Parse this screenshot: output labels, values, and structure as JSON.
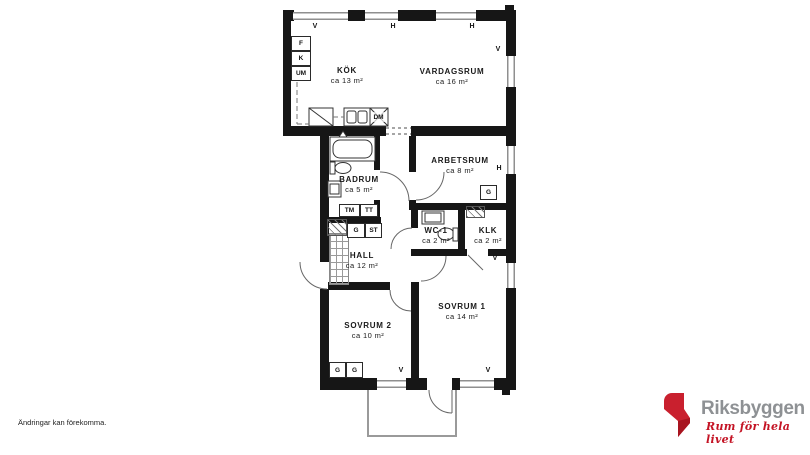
{
  "page": {
    "disclaimer": "Ändringar kan förekomma."
  },
  "brand": {
    "name": "Riksbyggen",
    "tagline": "Rum för hela livet",
    "red": "#c41425",
    "gray": "#8e9194"
  },
  "floorplan": {
    "rooms": [
      {
        "id": "kok",
        "name": "KÖK",
        "area": "ca 13 m²"
      },
      {
        "id": "vardagsrum",
        "name": "VARDAGSRUM",
        "area": "ca 16 m²"
      },
      {
        "id": "arbetsrum",
        "name": "ARBETSRUM",
        "area": "ca 8 m²"
      },
      {
        "id": "badrum",
        "name": "BADRUM",
        "area": "ca 5 m²"
      },
      {
        "id": "wc1",
        "name": "WC-1",
        "area": "ca 2 m²"
      },
      {
        "id": "klk",
        "name": "KLK",
        "area": "ca 2 m²"
      },
      {
        "id": "hall",
        "name": "HALL",
        "area": "ca 12 m²"
      },
      {
        "id": "sovrum2",
        "name": "SOVRUM 2",
        "area": "ca 10 m²"
      },
      {
        "id": "sovrum1",
        "name": "SOVRUM 1",
        "area": "ca 14 m²"
      }
    ],
    "appliances": {
      "f": "F",
      "k": "K",
      "um": "UM",
      "dm": "DM",
      "tm": "TM",
      "tt": "TT",
      "g": "G",
      "st": "ST"
    },
    "window_labels": {
      "v": "V",
      "h": "H"
    }
  }
}
